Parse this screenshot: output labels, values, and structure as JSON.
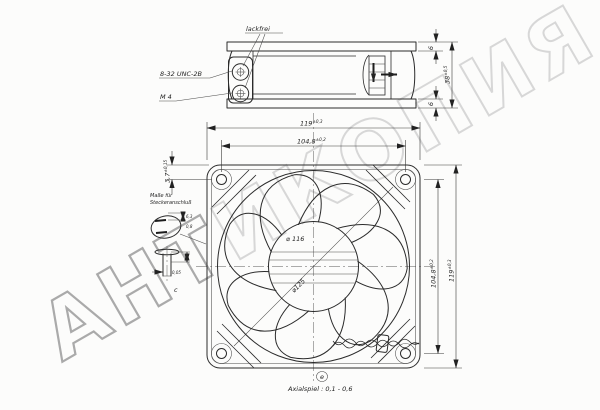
{
  "watermark": {
    "part1": "АНТ",
    "part2": "ИКОПИЯ"
  },
  "side_view": {
    "lackfrei_label": "lackfrei",
    "unc_thread_label": "8-32 UNC-2B",
    "m4_thread_label": "M 4",
    "dim_flange_top": "6",
    "dim_flange_bottom": "6",
    "dim_depth": {
      "v": "38",
      "t": "±0,5"
    }
  },
  "between": {
    "dim_width": {
      "v": "119",
      "t": "±0,3"
    },
    "dim_hole_spacing_h": {
      "v": "104,8",
      "t": "±0,2"
    }
  },
  "front_view": {
    "dim_hole_offset": {
      "v": "3,7",
      "t": "±0,15"
    },
    "dim_hole_spacing_v": {
      "v": "104,8",
      "t": "±0,2"
    },
    "dim_height": {
      "v": "119",
      "t": "±0,3"
    },
    "dim_venturi": "⌀ 116",
    "dim_blade_circle": "⌀125"
  },
  "connector": {
    "title_line1": "Maße für",
    "title_line2": "Steckeranschluß",
    "dim_tab_width": "6,3",
    "dim_tab_thickness": "0,8",
    "dim_tab_tol": "0,05",
    "section_label": "c"
  },
  "footer": {
    "section_label": "e",
    "axial_play_label": "Axialspiel : 0,1 - 0,6"
  }
}
